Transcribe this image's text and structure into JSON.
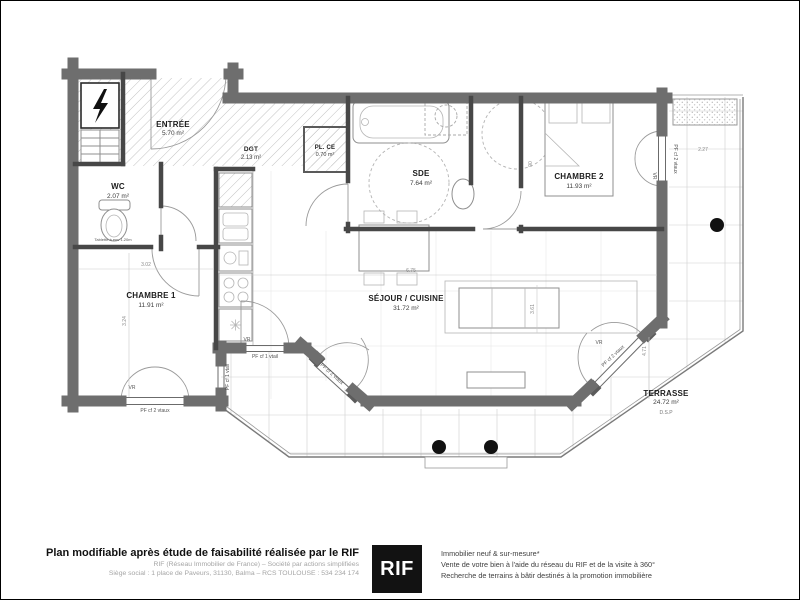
{
  "rooms": {
    "entree": {
      "name": "ENTRÉE",
      "area": "5.70 m²"
    },
    "dgt": {
      "name": "DGT",
      "area": "2.13 m²"
    },
    "plce": {
      "name": "PL. CE",
      "area": "0.70 m²"
    },
    "wc": {
      "name": "WC",
      "area": "2.07 m²"
    },
    "sde": {
      "name": "SDE",
      "area": "7.64 m²"
    },
    "chambre1": {
      "name": "CHAMBRE 1",
      "area": "11.91 m²"
    },
    "chambre2": {
      "name": "CHAMBRE 2",
      "area": "11.93 m²"
    },
    "sejour": {
      "name": "SÉJOUR / CUISINE",
      "area": "31.72 m²"
    },
    "terrasse": {
      "name": "TERRASSE",
      "area": "24.72 m²",
      "note": "D.S.P"
    }
  },
  "windows": {
    "double": "PF cf 2 vtaux",
    "single": "PF cf 1 vtail",
    "shutter": "VR"
  },
  "notes": {
    "wc_shelf": "Tablette à env 1.20m"
  },
  "dims": {
    "chambre1_w": "3.02",
    "chambre1_h": "3.24",
    "sejour_w": "6.75",
    "sejour_h": "3.61",
    "terrasse_h": "4.71",
    "terrasse_top": "2.27",
    "door_width": "90"
  },
  "footer": {
    "left_title": "Plan modifiable après étude de faisabilité réalisée par le RIF",
    "left_line1": "RIF (Réseau Immobilier de France) – Société par actions simplifiées",
    "left_line2": "Siège social : 1 place de Paveurs, 31130, Balma – RCS TOULOUSE : 534 234 174",
    "logo_text": "RIF",
    "right_line1": "Immobilier neuf & sur-mesure*",
    "right_line2": "Vente de votre bien à l'aide du réseau du RIF et de la visite à 360°",
    "right_line3": "Recherche de terrains à bâtir destinés à la promotion immobilière"
  },
  "colors": {
    "wall": "#6e6e6e",
    "partition": "#474747",
    "logo_bg": "#121212",
    "column_dot": "#111111"
  }
}
